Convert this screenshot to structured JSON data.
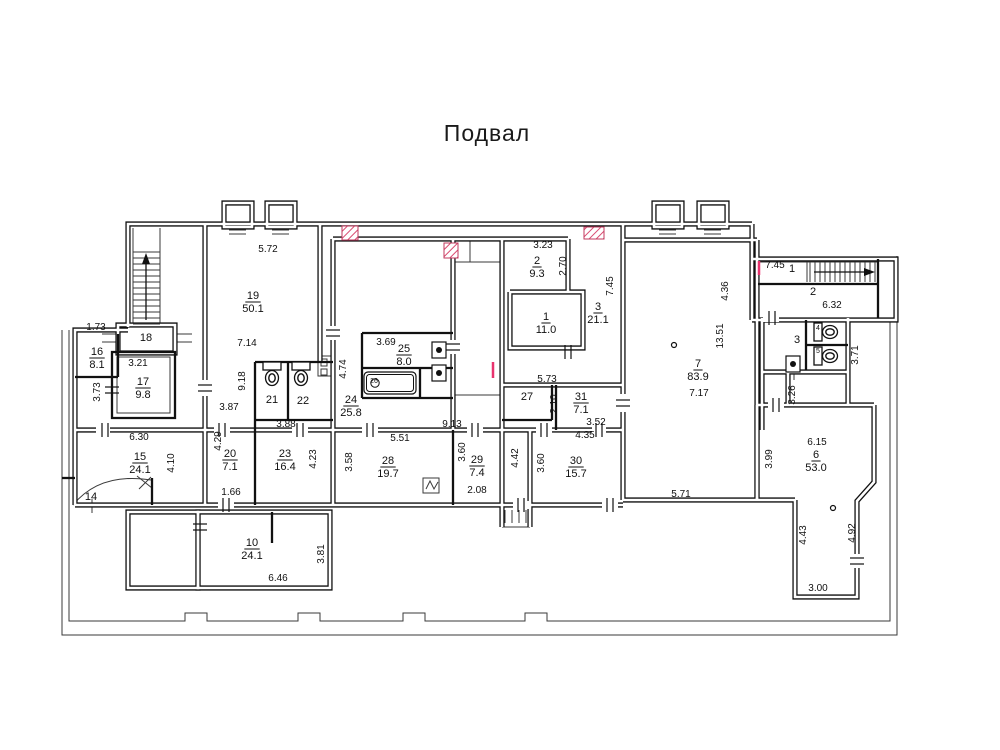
{
  "title": "Подвал",
  "canvas": {
    "w": 1000,
    "h": 750
  },
  "colors": {
    "wall": "#111111",
    "thin": "#3a3a3a",
    "text": "#111111",
    "hatch_line": "#d94a70",
    "hatch_border": "#c03a5e",
    "red_tick": "#e8336e",
    "background": "#ffffff"
  },
  "plan": {
    "hollow_walls": [
      "M128,327 L128,224 L752,224",
      "M752,224 L752,320",
      "M752,259 L896,259 L896,320 L752,320",
      "M205,224 L205,505",
      "M128,330 L75,330 L75,505",
      "M75,430 L623,430",
      "M75,505 L623,505",
      "M320,224 L320,362",
      "M333,239 L333,505",
      "M333,239 L568,239",
      "M453,239 L453,430",
      "M502,239 L502,430",
      "M502,430 L502,527",
      "M530,430 L530,527",
      "M510,292 L583,292 L583,348 L510,348 L510,292",
      "M568,239 L568,292",
      "M502,385 L623,385",
      "M623,224 L623,500",
      "M623,240 L757,240",
      "M757,240 L757,500",
      "M623,500 L795,500",
      "M757,405 L874,405",
      "M874,405 L874,482 L857,501 L857,597 L795,597 L795,500",
      "M757,405 L757,500",
      "M762,318 L762,430",
      "M762,372 L848,372",
      "M848,318 L848,405",
      "M788,372 L788,405",
      "M128,512 h70 v76 h-70 Z",
      "M198,512 h132 v76 h-132 Z",
      "M118,325 h57 v28 h-57 Z",
      "M224,203 h28 v24 h-28 Z",
      "M267,203 h28 v24 h-28 Z",
      "M654,203 h28 v24 h-28 Z",
      "M699,203 h28 v24 h-28 Z"
    ],
    "solid_walls": [
      "M75,377 L118,377",
      "M118,334 L118,377",
      "M112,352 h63 v66 h-63 Z",
      "M255,362 L333,362",
      "M255,362 L255,505",
      "M288,362 L288,420",
      "M255,420 L333,420",
      "M362,333 L453,333",
      "M362,333 L362,398",
      "M362,368 L453,368",
      "M420,368 L420,398",
      "M362,398 L453,398",
      "M453,430 L453,505",
      "M556,385 L556,430",
      "M552,385 L552,420",
      "M502,420 L552,420",
      "M806,320 L806,370",
      "M806,345 L848,345",
      "M272,512 L272,543",
      "M758,284 L878,284",
      "M878,259 L878,318",
      "M62,478 L75,478",
      "M152,478 L152,505"
    ],
    "thin_lines": [
      "M62,330 L62,635 L897,635 L897,256",
      "M69,330 L69,621 L185,621 L185,613 L207,613 L207,621 L298,621 L298,613 L320,613 L320,621 L403,621 L403,613 L425,613 L425,621 L525,621 L525,613 L547,613 L547,621 L890,621 L890,322",
      "M133,228 L133,327",
      "M160,228 L160,327",
      "M758,262 L878,262",
      "M807,262 L807,282",
      "M453,262 L502,262",
      "M470,239 L470,262",
      "M453,395 L502,395",
      "M502,527 L530,527",
      "M505,510 L505,523 M512,510 L512,523 M519,510 L519,523 M526,510 L526,523",
      "M229,230 h17 M229,234 h17",
      "M272,230 h17 M272,234 h17",
      "M659,230 h17 M659,234 h17",
      "M704,230 h17 M704,234 h17",
      "M102,334 h16 M102,342 h16",
      "M175,334 h17 M175,342 h17",
      "M318,356 h17 v20 h-17 Z",
      "M321,359 h6 v7 h-6 Z",
      "M321,369 h6 v6 h-6 Z",
      "M423,478 h16 v15 h-16 Z",
      "M426,489 L430,481 L434,489 L438,482",
      "M73,505 Q100,472 151,480",
      "M137,476 L152,488 M139,489 L151,477",
      "M92,499 L92,513",
      "M794,372 L794,380",
      "M117,357 h53 v56 h-53 Z"
    ],
    "gaps": [
      [
        96,
        426,
        14,
        8
      ],
      [
        214,
        426,
        16,
        8
      ],
      [
        292,
        426,
        16,
        8
      ],
      [
        362,
        426,
        16,
        8
      ],
      [
        467,
        426,
        16,
        8
      ],
      [
        536,
        426,
        16,
        8
      ],
      [
        592,
        426,
        14,
        8
      ],
      [
        218,
        501,
        16,
        8
      ],
      [
        513,
        501,
        16,
        8
      ],
      [
        602,
        501,
        16,
        8
      ],
      [
        201,
        380,
        8,
        16
      ],
      [
        619,
        394,
        8,
        18
      ],
      [
        763,
        314,
        16,
        8
      ],
      [
        768,
        401,
        16,
        8
      ],
      [
        329,
        326,
        8,
        14
      ],
      [
        449,
        340,
        8,
        14
      ],
      [
        853,
        554,
        8,
        14
      ]
    ],
    "hatches": [
      [
        342,
        226,
        16,
        14
      ],
      [
        444,
        243,
        14,
        15
      ],
      [
        584,
        227,
        20,
        12
      ]
    ],
    "red_ticks": [
      [
        493,
        362,
        493,
        378
      ],
      [
        759,
        261,
        759,
        275
      ]
    ],
    "stairs": [
      {
        "x1": 133,
        "y1": 252,
        "x2": 160,
        "y2": 325,
        "step": 6,
        "dir": "h"
      },
      {
        "x1": 810,
        "y1": 262,
        "x2": 876,
        "y2": 282,
        "step": 5,
        "dir": "v"
      }
    ],
    "arrows": [
      {
        "x1": 146,
        "y1": 320,
        "x2": 146,
        "y2": 262,
        "tip": "up"
      },
      {
        "x1": 814,
        "y1": 272,
        "x2": 866,
        "y2": 272,
        "tip": "right"
      }
    ],
    "wcs": [
      {
        "x": 272,
        "y": 374,
        "r": 0
      },
      {
        "x": 301,
        "y": 374,
        "r": 0
      },
      {
        "x": 826,
        "y": 332,
        "r": -90
      },
      {
        "x": 826,
        "y": 356,
        "r": -90
      }
    ],
    "bath": {
      "x": 364,
      "y": 372,
      "w": 52,
      "h": 22
    },
    "sinks": [
      [
        432,
        342
      ],
      [
        432,
        365
      ],
      [
        786,
        356
      ]
    ],
    "circles": [
      [
        674,
        345
      ],
      [
        833,
        508
      ]
    ],
    "ticks": [
      [
        105,
        430,
        "h"
      ],
      [
        222,
        430,
        "h"
      ],
      [
        300,
        430,
        "h"
      ],
      [
        370,
        430,
        "h"
      ],
      [
        475,
        430,
        "h"
      ],
      [
        544,
        430,
        "h"
      ],
      [
        599,
        430,
        "h"
      ],
      [
        226,
        505,
        "h"
      ],
      [
        521,
        505,
        "h"
      ],
      [
        610,
        505,
        "h"
      ],
      [
        205,
        388,
        "v"
      ],
      [
        333,
        333,
        "v"
      ],
      [
        453,
        347,
        "v"
      ],
      [
        623,
        403,
        "v"
      ],
      [
        857,
        561,
        "v"
      ],
      [
        200,
        527,
        "v"
      ],
      [
        568,
        352,
        "h"
      ],
      [
        772,
        318,
        "h"
      ],
      [
        112,
        390,
        "v"
      ],
      [
        776,
        405,
        "h"
      ]
    ],
    "rooms": [
      {
        "n": "19",
        "a": "50.1",
        "x": 253,
        "y": 299
      },
      {
        "n": "16",
        "a": "8.1",
        "x": 97,
        "y": 355
      },
      {
        "n": "17",
        "a": "9.8",
        "x": 143,
        "y": 385
      },
      {
        "n": "15",
        "a": "24.1",
        "x": 140,
        "y": 460
      },
      {
        "n": "20",
        "a": "7.1",
        "x": 230,
        "y": 457
      },
      {
        "n": "23",
        "a": "16.4",
        "x": 285,
        "y": 457
      },
      {
        "n": "10",
        "a": "24.1",
        "x": 252,
        "y": 546
      },
      {
        "n": "25",
        "a": "8.0",
        "x": 404,
        "y": 352
      },
      {
        "n": "24",
        "a": "25.8",
        "x": 351,
        "y": 403
      },
      {
        "n": "28",
        "a": "19.7",
        "x": 388,
        "y": 464
      },
      {
        "n": "29",
        "a": "7.4",
        "x": 477,
        "y": 463
      },
      {
        "n": "30",
        "a": "15.7",
        "x": 576,
        "y": 464
      },
      {
        "n": "31",
        "a": "7.1",
        "x": 581,
        "y": 400
      },
      {
        "n": "1",
        "a": "11.0",
        "x": 546,
        "y": 320
      },
      {
        "n": "2",
        "a": "9.3",
        "x": 537,
        "y": 264
      },
      {
        "n": "3",
        "a": "21.1",
        "x": 598,
        "y": 310
      },
      {
        "n": "7",
        "a": "83.9",
        "x": 698,
        "y": 367
      },
      {
        "n": "6",
        "a": "53.0",
        "x": 816,
        "y": 458
      }
    ],
    "labels": [
      {
        "t": "18",
        "x": 146,
        "y": 341,
        "s": 11
      },
      {
        "t": "21",
        "x": 272,
        "y": 403,
        "s": 11
      },
      {
        "t": "22",
        "x": 303,
        "y": 404,
        "s": 11
      },
      {
        "t": "26",
        "x": 374,
        "y": 383,
        "s": 7
      },
      {
        "t": "27",
        "x": 527,
        "y": 400,
        "s": 11
      },
      {
        "t": "14",
        "x": 91,
        "y": 500,
        "s": 11
      },
      {
        "t": "1",
        "x": 792,
        "y": 272,
        "s": 11
      },
      {
        "t": "2",
        "x": 813,
        "y": 295,
        "s": 11
      },
      {
        "t": "3",
        "x": 797,
        "y": 343,
        "s": 11
      },
      {
        "t": "4",
        "x": 818,
        "y": 330,
        "s": 7
      },
      {
        "t": "5",
        "x": 818,
        "y": 353,
        "s": 7
      }
    ],
    "dims": [
      {
        "t": "5.72",
        "x": 268,
        "y": 252
      },
      {
        "t": "7.14",
        "x": 247,
        "y": 346
      },
      {
        "t": "9.18",
        "x": 245,
        "y": 381,
        "r": 1
      },
      {
        "t": "1.73",
        "x": 96,
        "y": 330
      },
      {
        "t": "3.21",
        "x": 138,
        "y": 366
      },
      {
        "t": "3.73",
        "x": 100,
        "y": 392,
        "r": 1
      },
      {
        "t": "6.30",
        "x": 139,
        "y": 440
      },
      {
        "t": "4.10",
        "x": 174,
        "y": 463,
        "r": 1
      },
      {
        "t": "3.87",
        "x": 229,
        "y": 410
      },
      {
        "t": "4.29",
        "x": 221,
        "y": 441,
        "r": 1
      },
      {
        "t": "3.88",
        "x": 286,
        "y": 427
      },
      {
        "t": "4.23",
        "x": 316,
        "y": 459,
        "r": 1
      },
      {
        "t": "1.66",
        "x": 231,
        "y": 495
      },
      {
        "t": "3.69",
        "x": 386,
        "y": 345
      },
      {
        "t": "4.74",
        "x": 346,
        "y": 369,
        "r": 1
      },
      {
        "t": "5.51",
        "x": 400,
        "y": 441
      },
      {
        "t": "3.58",
        "x": 352,
        "y": 462,
        "r": 1
      },
      {
        "t": "9.13",
        "x": 452,
        "y": 427
      },
      {
        "t": "3.60",
        "x": 465,
        "y": 452,
        "r": 1
      },
      {
        "t": "2.08",
        "x": 477,
        "y": 493
      },
      {
        "t": "4.42",
        "x": 518,
        "y": 458,
        "r": 1
      },
      {
        "t": "3.60",
        "x": 544,
        "y": 463,
        "r": 1
      },
      {
        "t": "4.35",
        "x": 585,
        "y": 438
      },
      {
        "t": "3.52",
        "x": 596,
        "y": 425
      },
      {
        "t": "2.10",
        "x": 557,
        "y": 404,
        "r": 1
      },
      {
        "t": "5.73",
        "x": 547,
        "y": 382
      },
      {
        "t": "3.23",
        "x": 543,
        "y": 248
      },
      {
        "t": "2.70",
        "x": 566,
        "y": 266,
        "r": 1
      },
      {
        "t": "7.45",
        "x": 613,
        "y": 286,
        "r": 1
      },
      {
        "t": "4.36",
        "x": 728,
        "y": 291,
        "r": 1
      },
      {
        "t": "13.51",
        "x": 723,
        "y": 336,
        "r": 1
      },
      {
        "t": "7.17",
        "x": 699,
        "y": 396
      },
      {
        "t": "5.71",
        "x": 681,
        "y": 497
      },
      {
        "t": "7.45",
        "x": 775,
        "y": 268
      },
      {
        "t": "6.32",
        "x": 832,
        "y": 308
      },
      {
        "t": "3.71",
        "x": 858,
        "y": 355,
        "r": 1
      },
      {
        "t": "3.26",
        "x": 795,
        "y": 395,
        "r": 1
      },
      {
        "t": "6.15",
        "x": 817,
        "y": 445
      },
      {
        "t": "3.99",
        "x": 772,
        "y": 459,
        "r": 1
      },
      {
        "t": "4.43",
        "x": 806,
        "y": 535,
        "r": 1
      },
      {
        "t": "4.92",
        "x": 855,
        "y": 533,
        "r": 1
      },
      {
        "t": "3.00",
        "x": 818,
        "y": 591
      },
      {
        "t": "6.46",
        "x": 278,
        "y": 581
      },
      {
        "t": "3.81",
        "x": 324,
        "y": 554,
        "r": 1
      }
    ]
  }
}
